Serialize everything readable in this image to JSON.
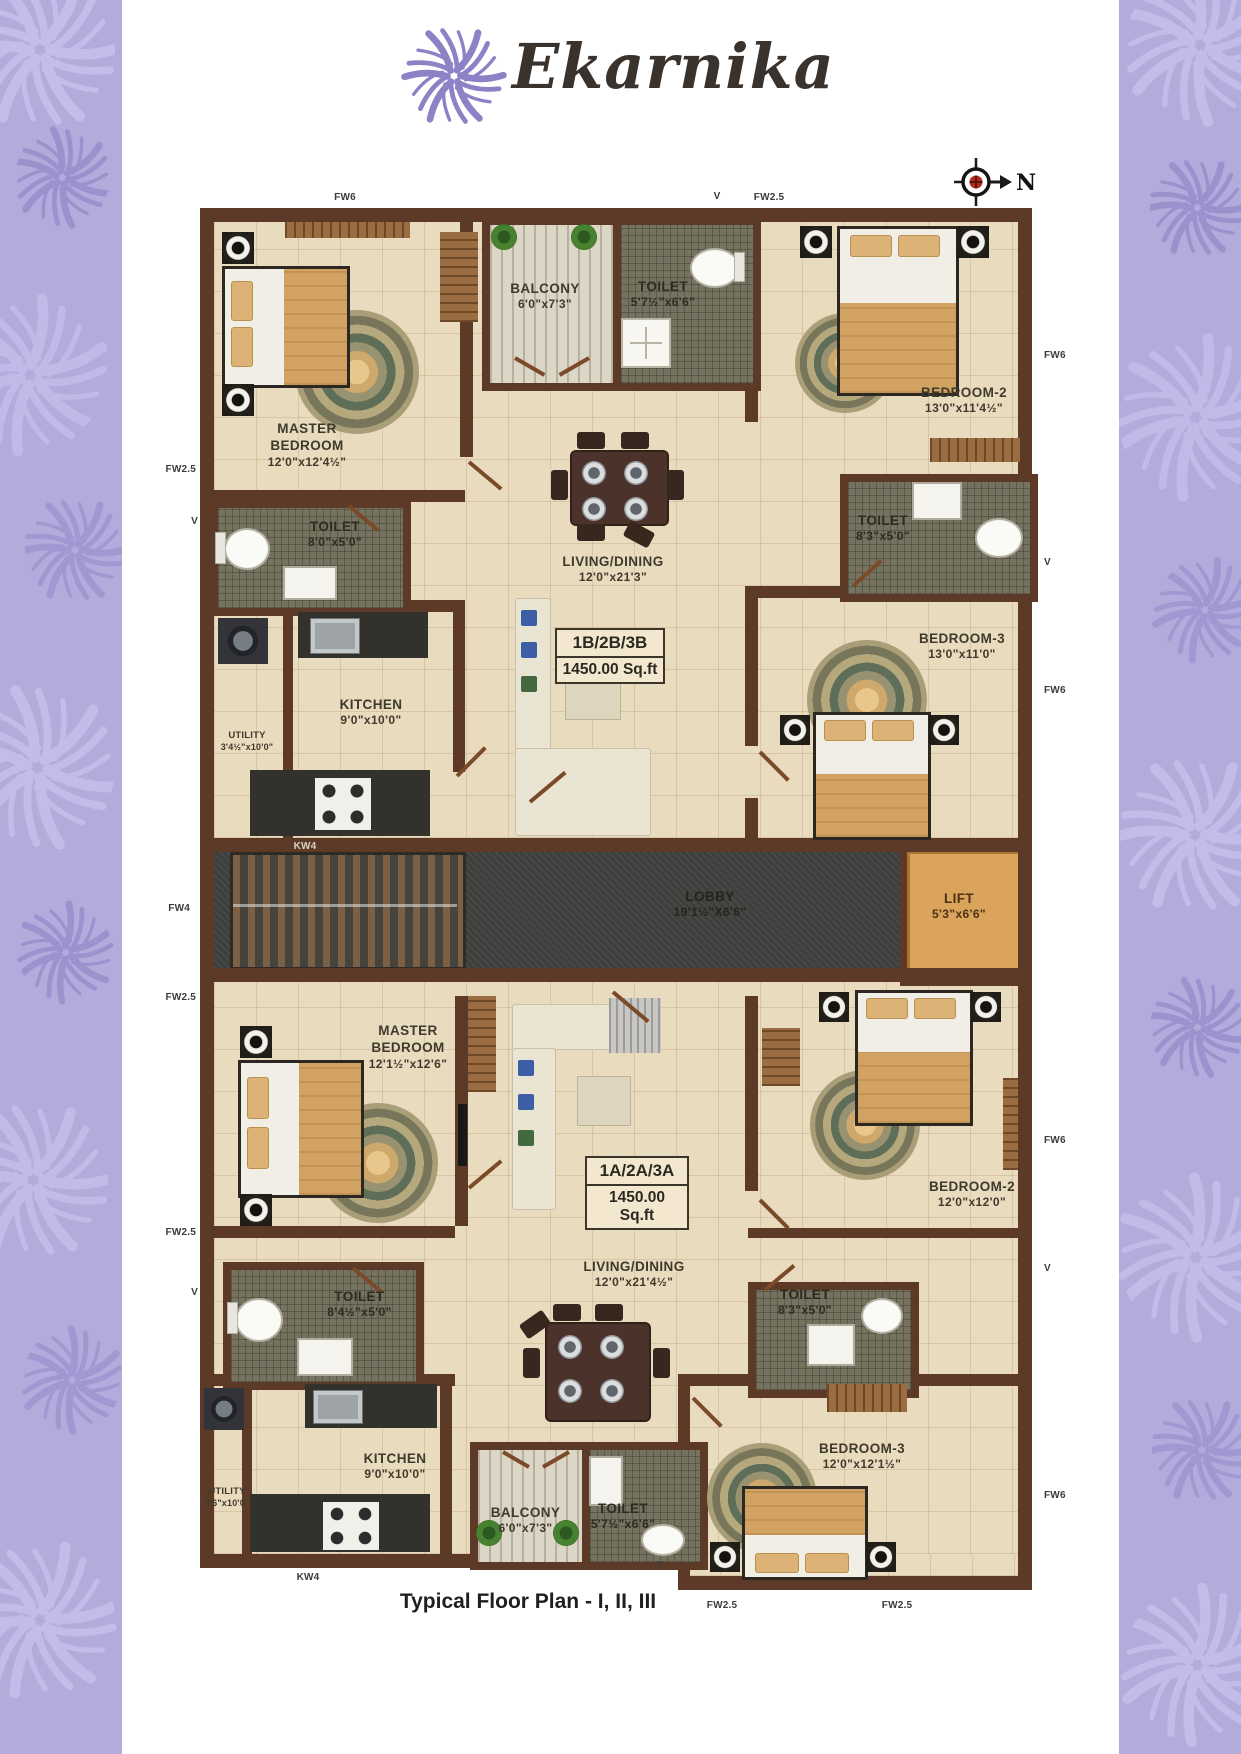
{
  "brand": {
    "name": "Ekarnika",
    "logo_icon": "pinwheel-star"
  },
  "compass": {
    "label": "N"
  },
  "caption": "Typical Floor Plan - I, II, III",
  "colors": {
    "pattern_purple": "#b2abdc",
    "brand_purple": "#8b83c6",
    "wall_brown": "#5c3a27",
    "floor_cream": "#e9dbbd",
    "toilet_tile": "#75735f",
    "lift_tan": "#dba45c",
    "lobby_dark": "#3e3f3d",
    "compass_red": "#b32b20"
  },
  "units": {
    "upper": {
      "badge": {
        "type": "1B/2B/3B",
        "area": "1450.00 Sq.ft"
      },
      "rooms": {
        "master": {
          "name": "MASTER BEDROOM",
          "dims": "12'0\"x12'4½\""
        },
        "balcony": {
          "name": "BALCONY",
          "dims": "6'0\"x7'3\""
        },
        "toilet_top": {
          "name": "TOILET",
          "dims": "5'7½\"x6'6\""
        },
        "bedroom2": {
          "name": "BEDROOM-2",
          "dims": "13'0\"x11'4½\""
        },
        "toilet_left": {
          "name": "TOILET",
          "dims": "8'0\"x5'0\""
        },
        "living": {
          "name": "LIVING/DINING",
          "dims": "12'0\"x21'3\""
        },
        "toilet_right": {
          "name": "TOILET",
          "dims": "8'3\"x5'0\""
        },
        "bedroom3": {
          "name": "BEDROOM-3",
          "dims": "13'0\"x11'0\""
        },
        "utility": {
          "name": "UTILITY",
          "dims": "3'4½\"x10'0\""
        },
        "kitchen": {
          "name": "KITCHEN",
          "dims": "9'0\"x10'0\""
        }
      }
    },
    "lower": {
      "badge": {
        "type": "1A/2A/3A",
        "area": "1450.00 Sq.ft"
      },
      "rooms": {
        "master": {
          "name": "MASTER BEDROOM",
          "dims": "12'1½\"x12'6\""
        },
        "bedroom2": {
          "name": "BEDROOM-2",
          "dims": "12'0\"x12'0\""
        },
        "toilet_left": {
          "name": "TOILET",
          "dims": "8'4½\"x5'0\""
        },
        "living": {
          "name": "LIVING/DINING",
          "dims": "12'0\"x21'4½\""
        },
        "toilet_right": {
          "name": "TOILET",
          "dims": "8'3\"x5'0\""
        },
        "kitchen": {
          "name": "KITCHEN",
          "dims": "9'0\"x10'0\""
        },
        "utility": {
          "name": "UTILITY",
          "dims": "3'6\"x10'0\""
        },
        "balcony": {
          "name": "BALCONY",
          "dims": "6'0\"x7'3\""
        },
        "toilet_bottom": {
          "name": "TOILET",
          "dims": "5'7½\"x6'6\""
        },
        "bedroom3": {
          "name": "BEDROOM-3",
          "dims": "12'0\"x12'1½\""
        }
      }
    }
  },
  "core": {
    "lobby": {
      "name": "LOBBY",
      "dims": "19'1½\"X6'6\""
    },
    "lift": {
      "name": "LIFT",
      "dims": "5'3\"x6'6\""
    }
  },
  "edge_labels": {
    "top": [
      "FW6",
      "V",
      "FW2.5"
    ],
    "right": [
      "FW6",
      "V",
      "FW6",
      "FW6",
      "V",
      "FW6"
    ],
    "left": [
      "FW2.5",
      "V",
      "FW4",
      "FW2.5",
      "FW2.5",
      "V"
    ],
    "bottom": [
      "KW4",
      "V",
      "FW2.5",
      "FW2.5"
    ],
    "kw4_upper": "KW4"
  }
}
